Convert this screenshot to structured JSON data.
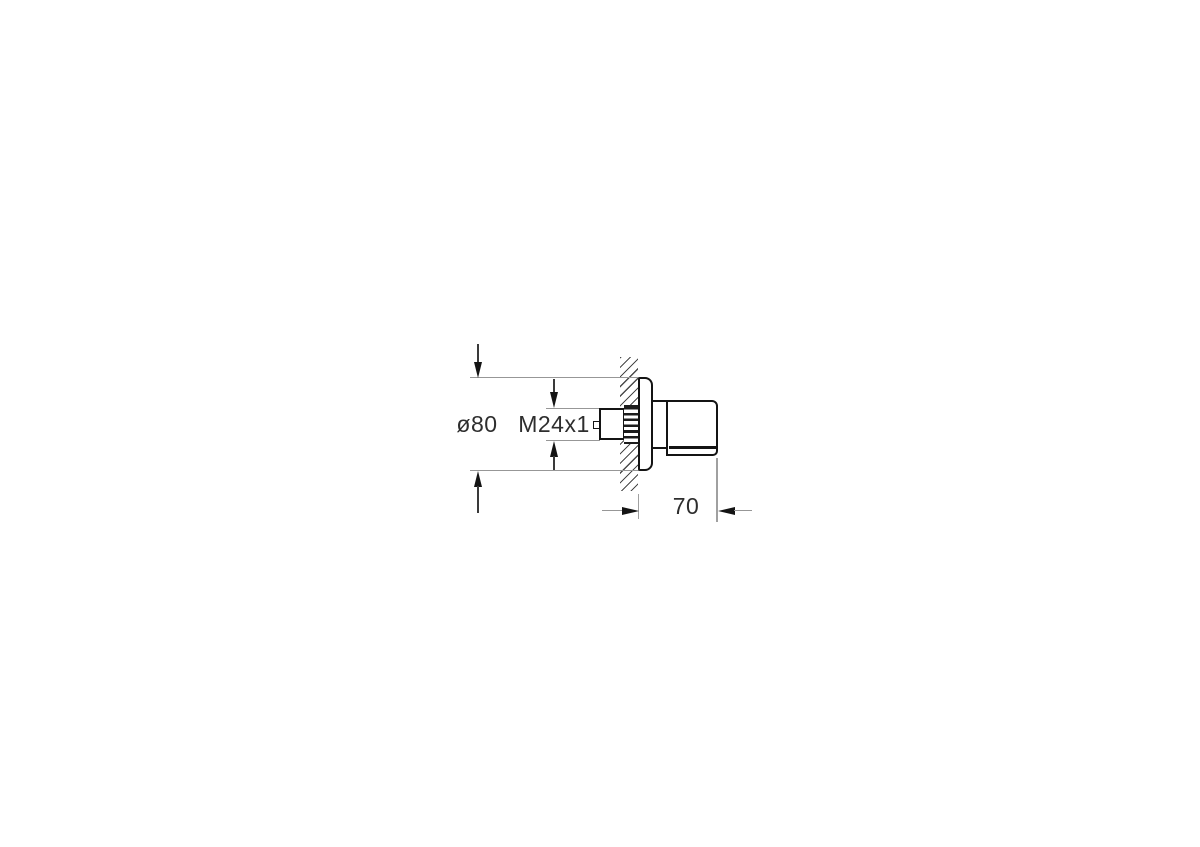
{
  "figure": {
    "kind": "technical-dimension-drawing",
    "view": "side section view of wall-mounted valve trim with escutcheon and knob"
  },
  "labels": {
    "diameter": "ø80",
    "thread": "M24x1",
    "depth": "70"
  },
  "colors": {
    "background": "#ffffff",
    "outline": "#141414",
    "dimension_line": "#979797",
    "extension_line": "#a0a0a0",
    "arrow_stem": "#3a3a3a",
    "arrowhead": "#141414",
    "hatch": "#4a4a4a",
    "text": "#2e2e2e"
  }
}
